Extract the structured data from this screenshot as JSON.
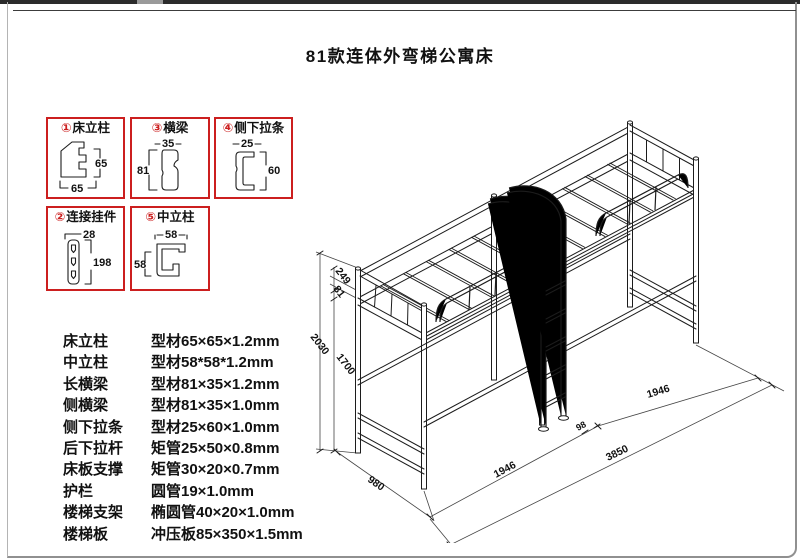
{
  "page": {
    "title": "81款连体外弯梯公寓床"
  },
  "detail_boxes": [
    {
      "num": "①",
      "name": "床立柱",
      "dim_right": "65",
      "dim_bottom": "65"
    },
    {
      "num": "③",
      "name": "横梁",
      "dim_top": "35",
      "dim_left": "81"
    },
    {
      "num": "④",
      "name": "侧下拉条",
      "dim_top": "25",
      "dim_right": "60"
    },
    {
      "num": "②",
      "name": "连接挂件",
      "dim_top": "28",
      "dim_right": "198"
    },
    {
      "num": "⑤",
      "name": "中立柱",
      "dim_top": "58",
      "dim_left": "58"
    }
  ],
  "specs": [
    {
      "part": "床立柱",
      "spec": "型材65×65×1.2mm"
    },
    {
      "part": "中立柱",
      "spec": "型材58*58*1.2mm"
    },
    {
      "part": "长横梁",
      "spec": "型材81×35×1.2mm"
    },
    {
      "part": "侧横梁",
      "spec": "型材81×35×1.0mm"
    },
    {
      "part": "侧下拉条",
      "spec": "型材25×60×1.0mm"
    },
    {
      "part": "后下拉杆",
      "spec": "矩管25×50×0.8mm"
    },
    {
      "part": "床板支撑",
      "spec": "矩管30×20×0.7mm"
    },
    {
      "part": "护栏",
      "spec": "圆管19×1.0mm"
    },
    {
      "part": "楼梯支架",
      "spec": "椭圆管40×20×1.0mm"
    },
    {
      "part": "楼梯板",
      "spec": "冲压板85×350×1.5mm"
    }
  ],
  "bed_dimensions": {
    "total_height": "2030",
    "platform_height": "1700",
    "guardrail_height": "249",
    "beam_height": "81",
    "width": "980",
    "bay_left": "1946",
    "bay_right": "1946",
    "total_length": "3850",
    "ladder_offset": "98"
  },
  "colors": {
    "accent_red": "#cc1f1f",
    "line": "#1c1c1c"
  }
}
